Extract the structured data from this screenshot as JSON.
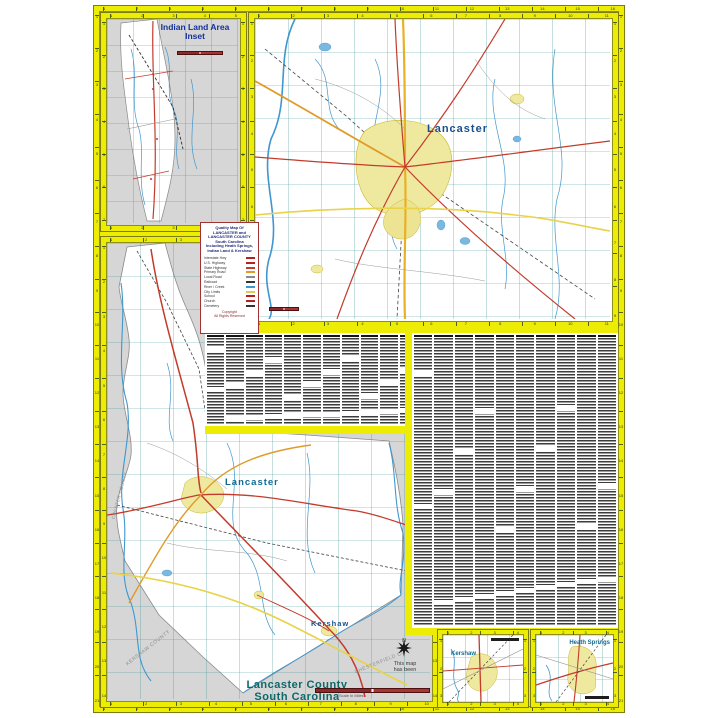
{
  "indian_inset": {
    "title_line1": "Indian Land Area",
    "title_line2": "Inset"
  },
  "main_map": {
    "city_label": "Lancaster"
  },
  "county_map": {
    "city_label": "Lancaster",
    "town_label": "Kershaw",
    "diag_label_1": "KERSHAW COUNTY",
    "diag_label_2": "CHESTERFIELD CO.",
    "diag_label_3": "CHESTER COUNTY",
    "compass_label": "N",
    "note_line1": "This map",
    "note_line2": "has been",
    "title_line1": "Lancaster County",
    "title_line2": "South Carolina",
    "scale_caption": "Scale in Miles"
  },
  "town_insets": {
    "kershaw": {
      "label": "Kershaw"
    },
    "heath_springs": {
      "label": "Heath Springs"
    }
  },
  "legend": {
    "title_lines": [
      "Quality Map Of",
      "LANCASTER and",
      "LANCASTER COUNTY",
      "South Carolina",
      "Including Heath Springs,",
      "Indian Land & Kershaw"
    ],
    "items": [
      {
        "label": "Interstate Hwy",
        "color": "#b22222"
      },
      {
        "label": "U.S. Highway",
        "color": "#b22222"
      },
      {
        "label": "State Highway",
        "color": "#c23b2b"
      },
      {
        "label": "Primary Road",
        "color": "#e09a28"
      },
      {
        "label": "Local Road",
        "color": "#8a8a8a"
      },
      {
        "label": "Railroad",
        "color": "#333333"
      },
      {
        "label": "River / Creek",
        "color": "#3f97cf"
      },
      {
        "label": "City Limits",
        "color": "#d8cc5a"
      },
      {
        "label": "School",
        "color": "#b22222"
      },
      {
        "label": "Church",
        "color": "#b22222"
      },
      {
        "label": "Cemetery",
        "color": "#333333"
      }
    ],
    "footer_lines": [
      "Copyright",
      "All Rights Reserved"
    ]
  },
  "index": {
    "top_columns": 12,
    "right_columns": 10
  },
  "ticks": {
    "sheet_h": 16,
    "sheet_v": 21,
    "indian_h": 5,
    "indian_v": 7,
    "main_h": 11,
    "main_v": 9,
    "county_h": 10,
    "county_v": 14,
    "town_h": 4,
    "town_v": 3
  }
}
